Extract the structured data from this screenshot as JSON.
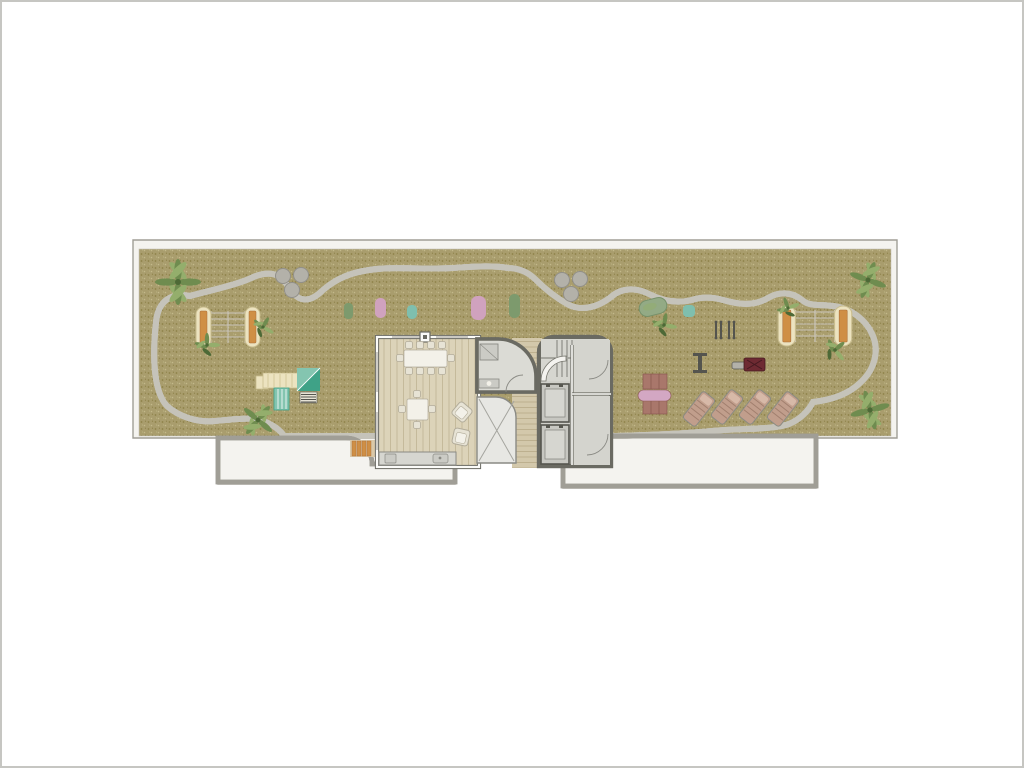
{
  "plan": {
    "type": "architectural-floor-plan",
    "view": "rooftop-terrace-top-view",
    "areas": [
      "lawn",
      "hex-paved-terrace",
      "penthouse-interior",
      "bathroom",
      "stair-elevator-core",
      "wood-deck-corridor",
      "skylight-void",
      "lower-roof-left",
      "lower-roof-right"
    ]
  },
  "inventory": [
    {
      "item": "palm-tree",
      "count": 4
    },
    {
      "item": "shrub-plant",
      "count": 5
    },
    {
      "item": "hammock-frame",
      "count": 2
    },
    {
      "item": "round-planter-cluster",
      "count": 2,
      "circles_each": 3
    },
    {
      "item": "lounge-mat",
      "count": 5,
      "colors": [
        "green",
        "pink",
        "teal",
        "pink",
        "green"
      ]
    },
    {
      "item": "kids-play-structure-with-slide",
      "count": 1
    },
    {
      "item": "bean-lounger",
      "count": 1
    },
    {
      "item": "gym-dumbbell",
      "count": 2
    },
    {
      "item": "gym-bench",
      "count": 1
    },
    {
      "item": "gym-press-machine",
      "count": 1
    },
    {
      "item": "picnic-table-with-benches",
      "count": 1
    },
    {
      "item": "sun-lounger",
      "count": 4
    },
    {
      "item": "dining-table-10-seats",
      "count": 1
    },
    {
      "item": "square-table-4-seats",
      "count": 1
    },
    {
      "item": "armchair",
      "count": 2
    },
    {
      "item": "kitchen-counter-with-sink",
      "count": 1
    },
    {
      "item": "shower",
      "count": 1
    },
    {
      "item": "elevator",
      "count": 2
    },
    {
      "item": "staircase",
      "count": 1
    },
    {
      "item": "wood-steps",
      "count": 1
    }
  ],
  "palette": {
    "page_border": "#c6c6c2",
    "parapet": "#f4f3ef",
    "outline": "#a09e96",
    "grass_base": "#a99d6d",
    "grass_dark": "#8d8149",
    "grass_light": "#c3b98a",
    "hex_bg": "#e6e4df",
    "hex_tile": "#f0efeb",
    "hex_line": "#d8d6cf",
    "rim_gray": "#c5c3ba",
    "rim_white": "#f7f6f2",
    "wood": "#dcd3b9",
    "wood_line": "#c5ba9b",
    "deck": "#d3c8ab",
    "deck_line": "#bdb08f",
    "concrete": "#b4b8af",
    "concrete_dark": "#a7aba1",
    "concrete_light": "#c2c6bc",
    "wall_dark": "#6a6a62",
    "wall_white": "#fbfbf8",
    "core_floor": "#d0d0ca",
    "room_floor": "#d4d4ce",
    "stair_floor": "#d6d6d0",
    "bath_floor": "#dbdbd5",
    "fixture": "#cbcbc5",
    "fixture_line": "#8a8a84",
    "skylight": "#e7e7e3",
    "skylight_line": "#a5a59f",
    "elevator": "#c7c7c1",
    "elevator_door": "#d6d6d0",
    "elevator_frame": "#56564f",
    "tread": "#76766e",
    "table_white": "#f3f1e9",
    "chair": "#e7e3d5",
    "chair_line": "#b2ac9a",
    "cream": "#ece3c0",
    "cream_line": "#c9bd8e",
    "plank": "#cf8f45",
    "plank_line": "#a86a38",
    "net": "#cac5bb",
    "teal_dark": "#3fa287",
    "teal_light": "#84c5b0",
    "mat_green": "#7d9a6d",
    "mat_pink": "#d0a2be",
    "mat_teal": "#7fbfae",
    "bean": "#93aa85",
    "bean_line": "#76906a",
    "planter": "#b3b1a9",
    "planter_line": "#92908a",
    "gym": "#54544e",
    "maroon": "#6e2a32",
    "maroon_dark": "#451a20",
    "bench_brown": "#a9776b",
    "bench_line": "#8b5b51",
    "pink_tbl": "#d3a7c3",
    "lounger": "#c19e8c",
    "lounger_line": "#a17f6e",
    "lounger_frame": "#8b8b83",
    "lounger_head": "#d7b9a8",
    "palm": "#6f8c4f",
    "palm_light": "#94ae6c",
    "palm_dark": "#4d6936",
    "steps_bg": "#dac9a9",
    "window": "#9a968c",
    "white": "#ffffff"
  }
}
